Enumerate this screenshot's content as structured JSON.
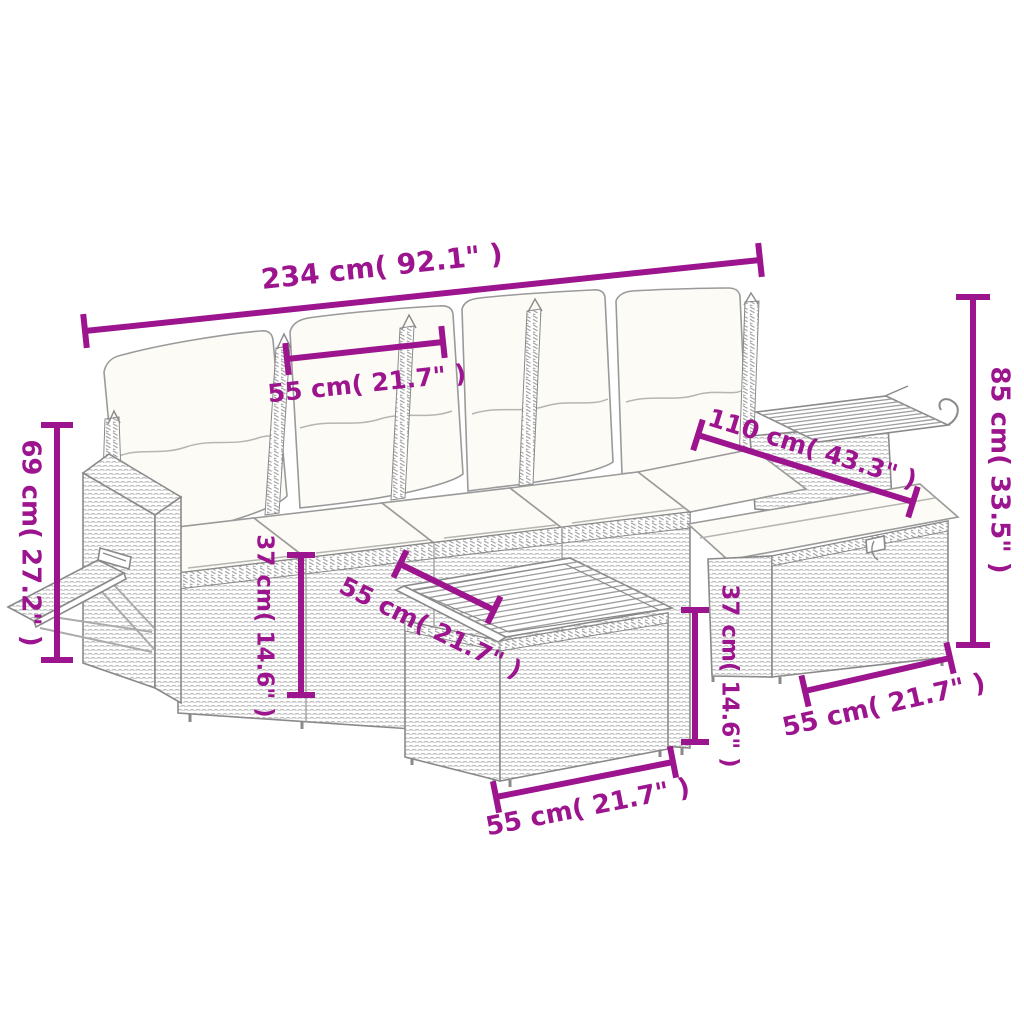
{
  "canvas": {
    "width": 1024,
    "height": 1024,
    "background": "#ffffff"
  },
  "style": {
    "dimension_color": "#9C148E",
    "outline_color": "#8a8a8a",
    "wicker_texture_color": "#b9b9b9",
    "cushion_color": "#fcfbf6"
  },
  "drawing": {
    "kind": "product dimension line drawing",
    "components": [
      "four-seat rattan sofa with back pillows",
      "storage armrest with fold-out side shelf",
      "corner armrest with slatted wood shelf",
      "storage ottoman with seat cushion",
      "square table with slatted wood top"
    ]
  },
  "dimensions": [
    {
      "id": "overall-width",
      "label": "234 cm( 92.1\" )",
      "orientation": "horizontal-top"
    },
    {
      "id": "seat-module-width",
      "label": "55 cm( 21.7\" )",
      "orientation": "horizontal"
    },
    {
      "id": "overall-height",
      "label": "85 cm( 33.5\" )",
      "orientation": "vertical-right"
    },
    {
      "id": "corner-ottoman-depth",
      "label": "110 cm( 43.3\" )",
      "orientation": "diagonal"
    },
    {
      "id": "armrest-height",
      "label": "69 cm( 27.2\" )",
      "orientation": "vertical-left"
    },
    {
      "id": "seat-height",
      "label": "37 cm( 14.6\" )",
      "orientation": "vertical"
    },
    {
      "id": "table-top-depth",
      "label": "55 cm( 21.7\" )",
      "orientation": "diagonal"
    },
    {
      "id": "ottoman-height",
      "label": "37 cm( 14.6\" )",
      "orientation": "vertical"
    },
    {
      "id": "table-width",
      "label": "55 cm( 21.7\" )",
      "orientation": "horizontal"
    },
    {
      "id": "ottoman-width",
      "label": "55 cm( 21.7\" )",
      "orientation": "horizontal"
    }
  ]
}
